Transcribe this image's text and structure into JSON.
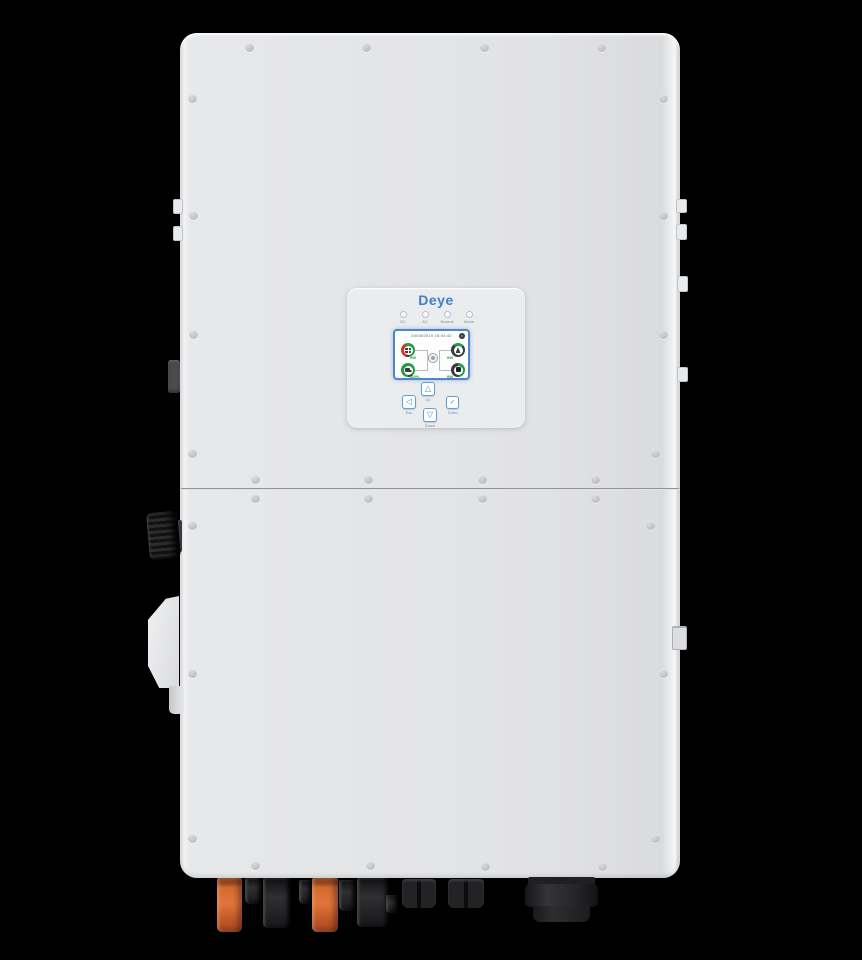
{
  "background_color": "#000000",
  "device": {
    "name": "Deye hybrid solar inverter - front view",
    "body_color": "#e3e4e6",
    "brand": "Deye",
    "brand_color": "#3f7fd1"
  },
  "display": {
    "logo_text": "Deye",
    "leds": [
      {
        "label": "DC"
      },
      {
        "label": "AC"
      },
      {
        "label": "Normal"
      },
      {
        "label": "Alarm"
      }
    ],
    "screen": {
      "status_bar": "04/06/2019 15:04:40",
      "gauges": [
        {
          "name": "pv",
          "icon": "solar-panel-icon",
          "value": "0W"
        },
        {
          "name": "grid",
          "icon": "grid-tower-icon",
          "value": "0W"
        },
        {
          "name": "battery",
          "icon": "battery-icon",
          "value": "100%"
        },
        {
          "name": "load",
          "icon": "load-icon",
          "value": "0W"
        }
      ],
      "accent_green": "#1f9d44",
      "accent_red": "#d9342b",
      "frame_blue": "#4f86c9"
    },
    "buttons": [
      {
        "name": "up",
        "glyph": "△",
        "label": "Up"
      },
      {
        "name": "esc",
        "glyph": "◁",
        "label": "Esc"
      },
      {
        "name": "enter",
        "glyph": "✓",
        "label": "Enter"
      },
      {
        "name": "down",
        "glyph": "▽",
        "label": "Down"
      }
    ]
  }
}
